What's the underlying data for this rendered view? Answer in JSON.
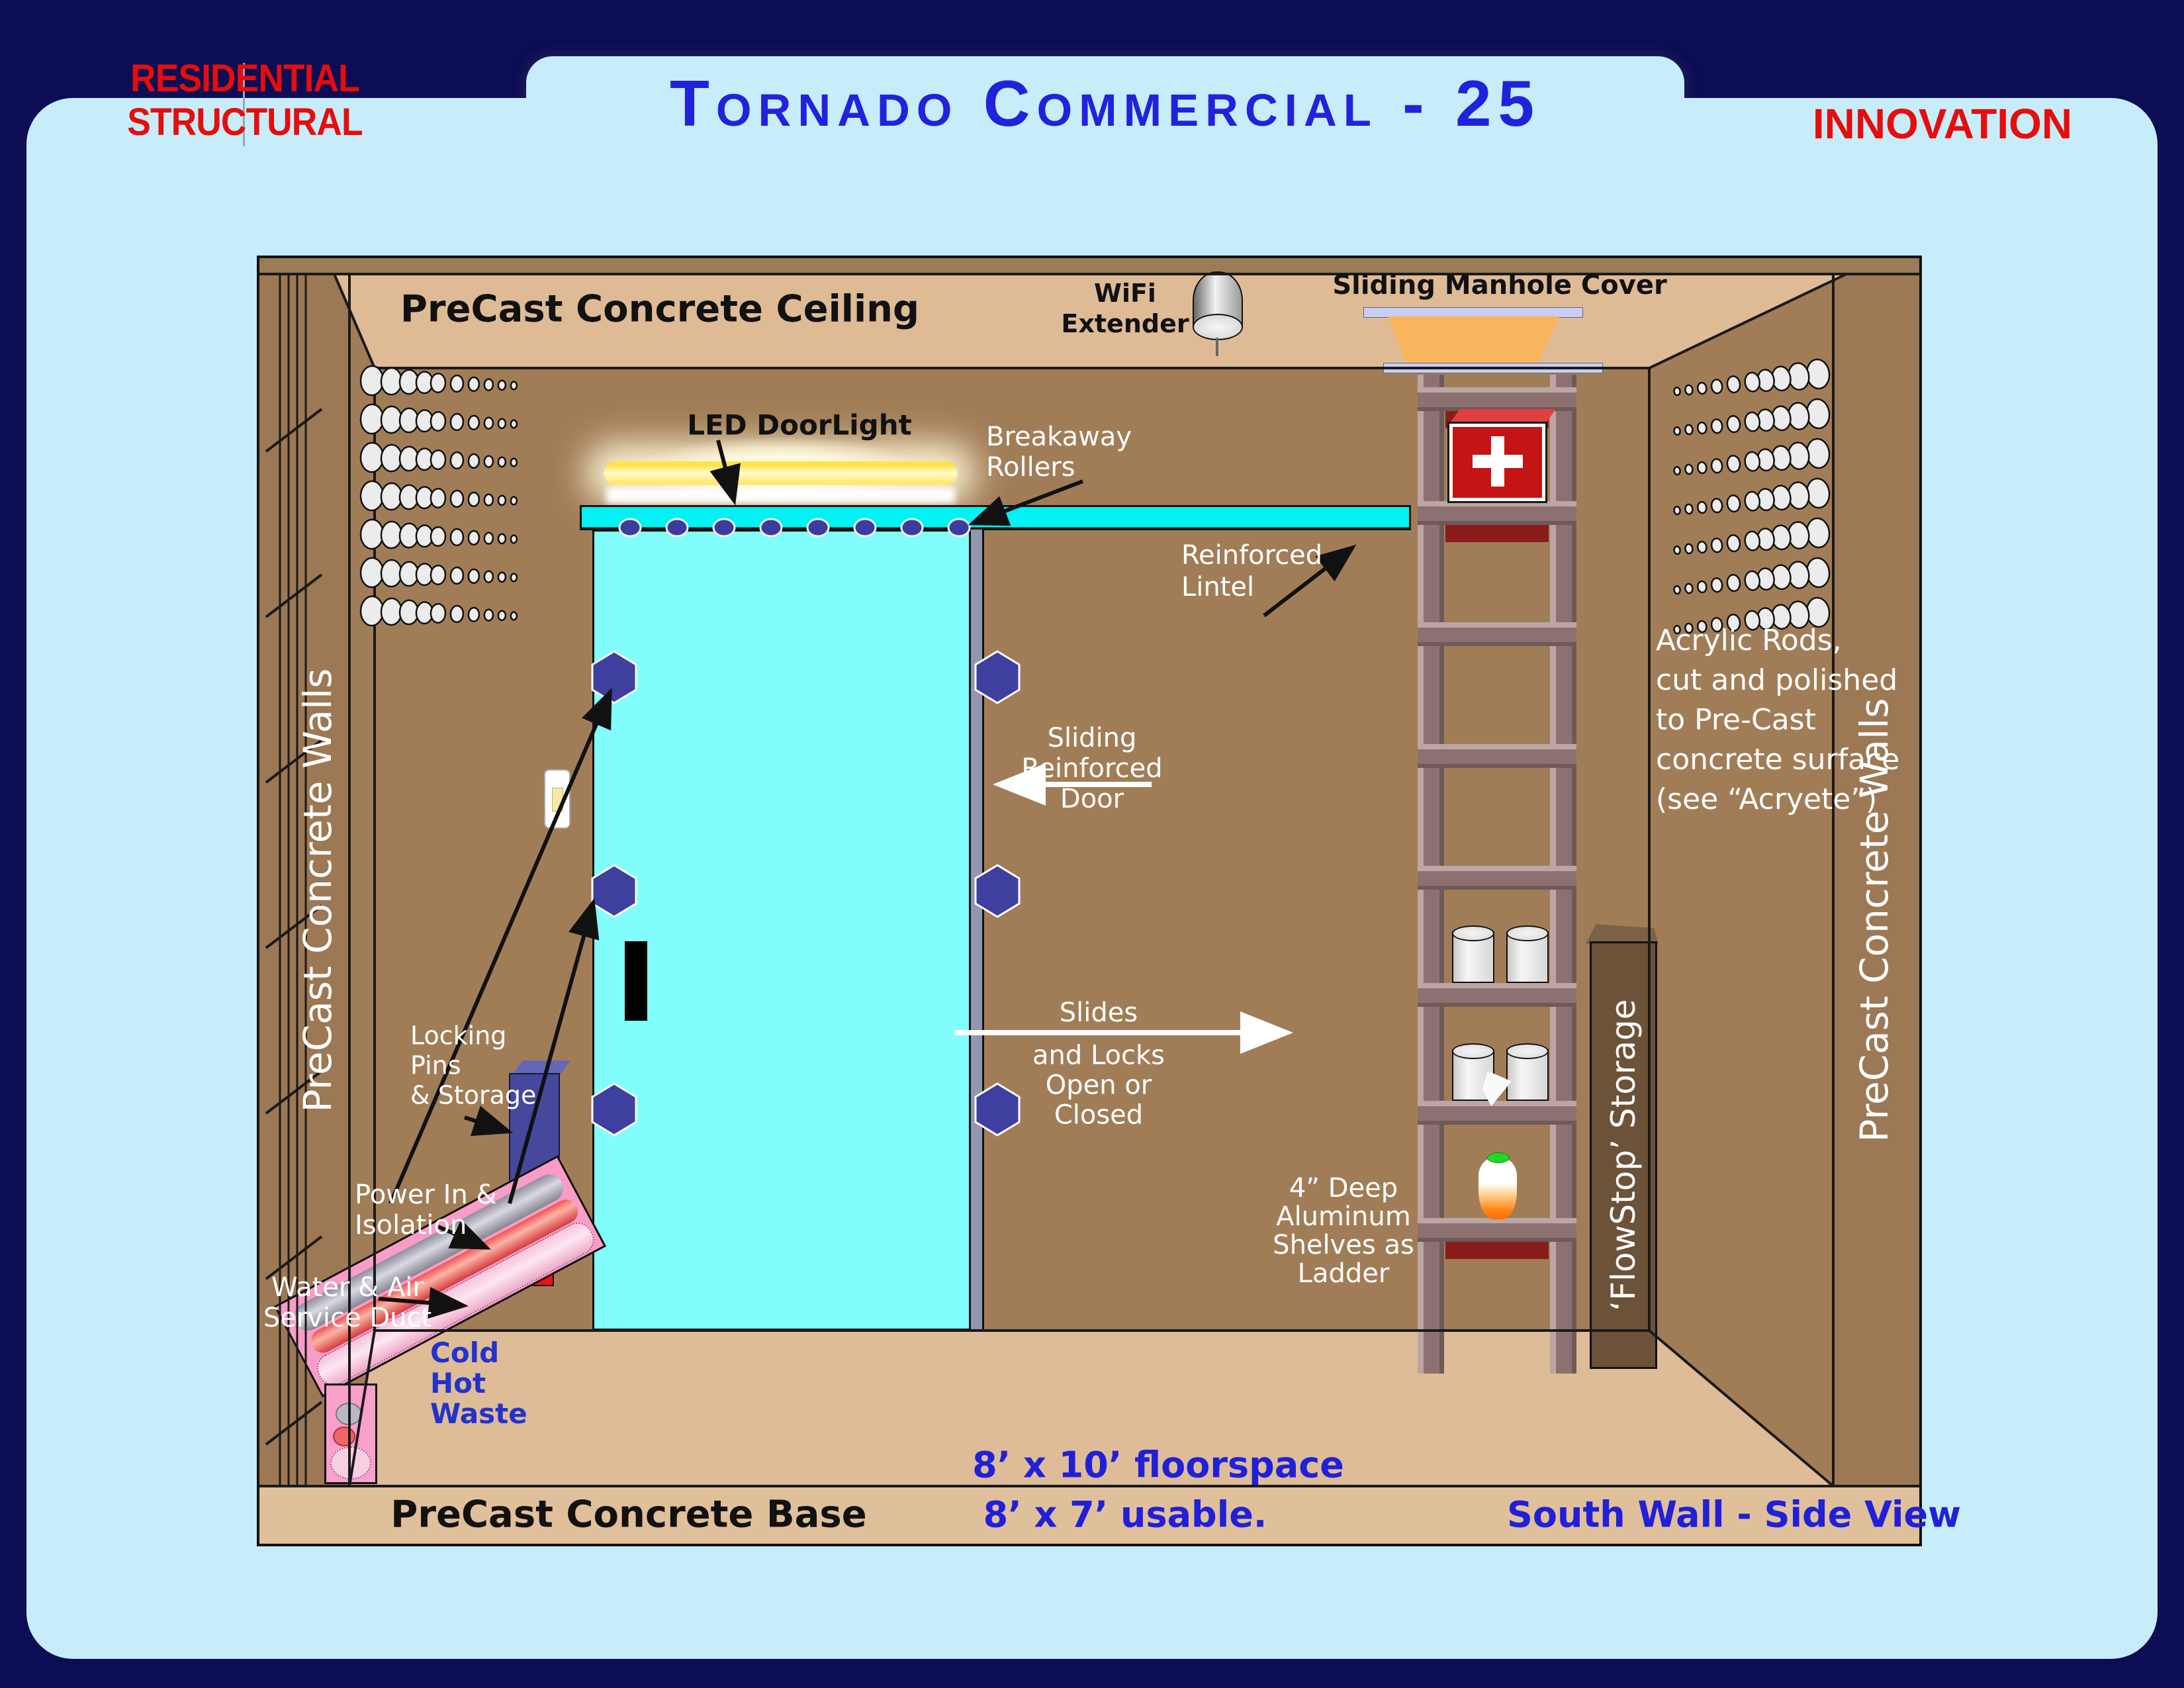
{
  "header": {
    "left_line1": "RESIDENTIAL",
    "left_line2": "STRUCTURAL",
    "title": "Tornado Commercial - 25",
    "right": "INNOVATION"
  },
  "colors": {
    "border_navy": "#0d0d55",
    "panel_blue": "#c7edfb",
    "wall_brown": "#a17d57",
    "ceiling_tan": "#debb95",
    "door_cyan": "#82fdfd",
    "track_cyan": "#00f2f2",
    "accent_red": "#e60d0d",
    "title_blue": "#2222dd",
    "label_blue": "#2020d8"
  },
  "diagram": {
    "ceiling_label": "PreCast Concrete Ceiling",
    "wifi": {
      "line1": "WiFi",
      "line2": "Extender"
    },
    "manhole_label": "Sliding Manhole Cover",
    "led_label": "LED DoorLight",
    "breakaway": {
      "line1": "Breakaway",
      "line2": "Rollers"
    },
    "lintel": {
      "line1": "Reinforced",
      "line2": "Lintel"
    },
    "left_wall_label": "PreCast Concrete Walls",
    "right_wall_label": "PreCast Concrete Walls",
    "sliding_door": {
      "line1": "Sliding",
      "line2": "Reinforced",
      "line3": "Door"
    },
    "slides_locks": {
      "line1": "Slides",
      "line2": "and Locks",
      "line3": "Open or",
      "line4": "Closed"
    },
    "acrylic": {
      "line1": "Acrylic Rods,",
      "line2": "cut and polished",
      "line3": "to Pre-Cast",
      "line4": "concrete surface",
      "line5": "(see “Acryete”)"
    },
    "shelves": {
      "line1": "4” Deep",
      "line2": "Aluminum",
      "line3": "Shelves as",
      "line4": "Ladder"
    },
    "flowstop_label": "‘FlowStop’  Storage",
    "locking": {
      "line1": "Locking",
      "line2": "Pins",
      "line3": "& Storage"
    },
    "power": {
      "line1": "Power In &",
      "line2": "Isolation"
    },
    "water": {
      "line1": "Water & Air",
      "line2": "Service Duct"
    },
    "pipes": {
      "line1": "Cold",
      "line2": "Hot",
      "line3": "Waste"
    },
    "floorspace": "8’ x 10’ floorspace",
    "usable": "8’ x 7’ usable.",
    "base_label": "PreCast Concrete Base",
    "view_label": "South Wall - Side View"
  }
}
